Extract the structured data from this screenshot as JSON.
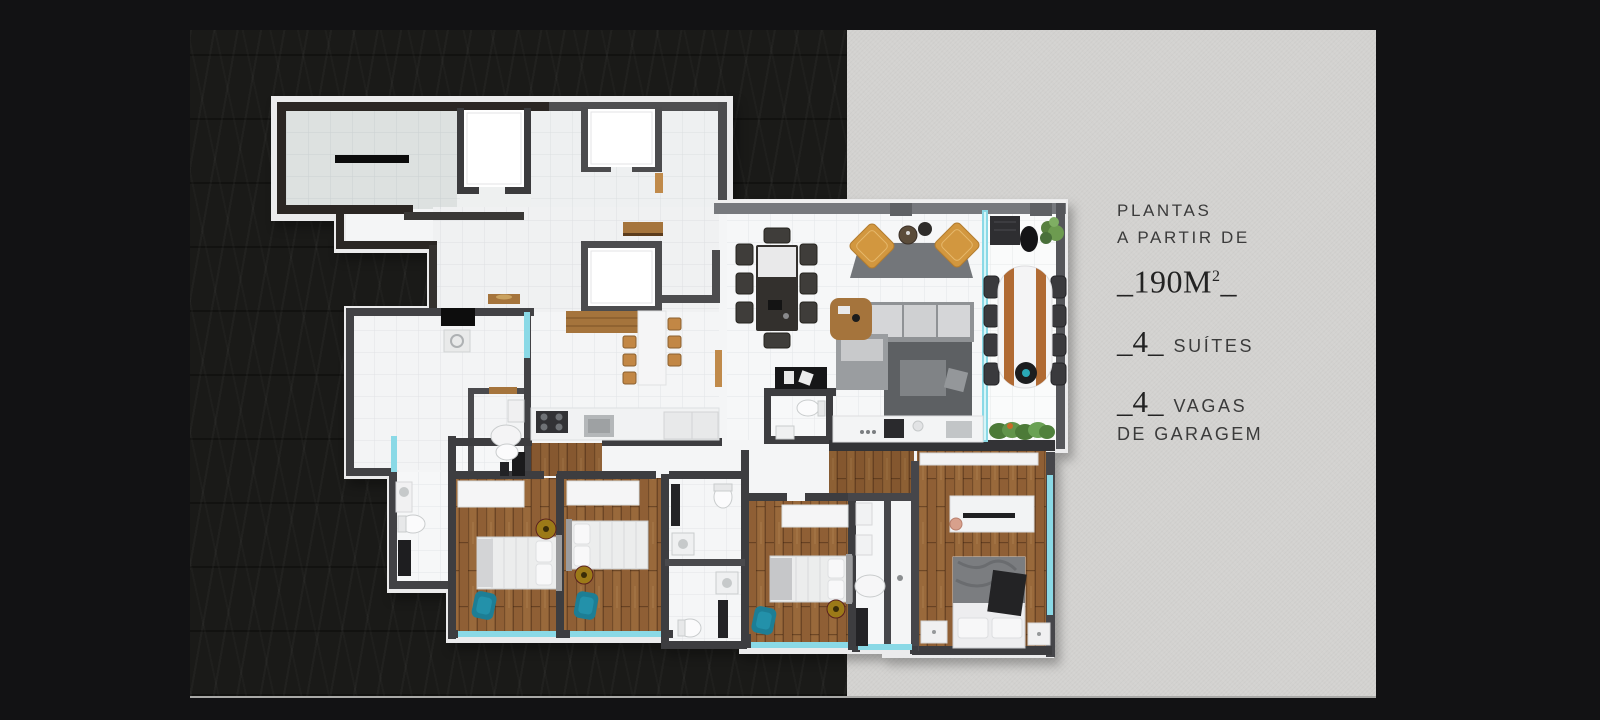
{
  "banner": {
    "headline": {
      "line1": "PLANTAS",
      "line2": "A PARTIR DE"
    },
    "area": {
      "prefix": "_190M",
      "sup": "2",
      "suffix": "_"
    },
    "features": [
      {
        "num": "_4_",
        "label": "SUÍTES"
      },
      {
        "num": "_4_",
        "label": "VAGAS",
        "label2": "DE GARAGEM"
      }
    ],
    "colors": {
      "bg_outer": "#121214",
      "panel_dark": "#1a1a18",
      "panel_light": "#d3d2d0",
      "text": "#3b3b3b",
      "text_strong": "#232323",
      "glass": "#8ad9e6",
      "wood_floor": "#96673a",
      "teal_chair": "#1d7e95",
      "tan_chair": "#d2973f"
    }
  }
}
